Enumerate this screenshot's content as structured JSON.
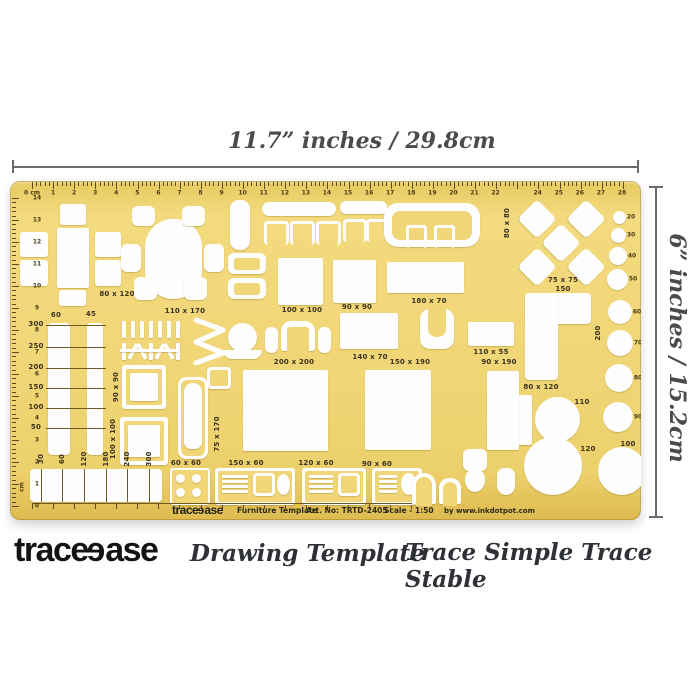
{
  "annotations": {
    "width_label": "11.7” inches / 29.8cm",
    "height_label": "6” inches / 15.2cm"
  },
  "template": {
    "top_ruler": [
      "0 cm",
      "1",
      "2",
      "3",
      "4",
      "5",
      "6",
      "7",
      "8",
      "9",
      "10",
      "11",
      "12",
      "13",
      "14",
      "15",
      "16",
      "17",
      "18",
      "19",
      "20",
      "21",
      "22",
      "24",
      "25",
      "26",
      "27",
      "28"
    ],
    "left_ruler": [
      "14",
      "13",
      "12",
      "11",
      "10",
      "9",
      "8",
      "7",
      "6",
      "5",
      "4",
      "3",
      "2",
      "1",
      "0"
    ],
    "left_ruler_unit": "cm",
    "size_labels": [
      "80 x 120",
      "110 x 170",
      "100 x 100",
      "90 x 90",
      "180 x 70",
      "140 x 70",
      "200 x 200",
      "150 x 190",
      "110 x 55",
      "90 x 190",
      "80 x 120",
      "110",
      "120",
      "100",
      "75 x 75",
      "150",
      "60 x 60",
      "150 x 60",
      "120 x 60",
      "90 x 60"
    ],
    "vertical_labels": [
      "80 x 80",
      "90 x 90",
      "100 x 100",
      "75 x 170",
      "200"
    ],
    "circle_labels": [
      "20",
      "30",
      "40",
      "50",
      "60",
      "70",
      "80",
      "90"
    ],
    "left_scale": [
      "300",
      "250",
      "200",
      "150",
      "100",
      "50"
    ],
    "slot_headers": [
      "60",
      "45"
    ],
    "bottom_scale": [
      "30",
      "60",
      "120",
      "180",
      "240",
      "300"
    ],
    "print": {
      "logo_pre": "trace",
      "logo_rev": "e",
      "logo_post": "ase",
      "subtitle": "Furniture Template",
      "art_no": "Art. No: TRTD-2405",
      "scale": "Scale - 1:50",
      "credit": "by www.inkdotpot.com"
    }
  },
  "branding": {
    "logo_pre": "trace",
    "logo_rev": "e",
    "logo_post": "ase",
    "tagline": "Drawing Template",
    "slogan": "Trace Simple Trace Stable"
  },
  "colors": {
    "template_yellow": "#f1d677",
    "template_edge": "#c9a83a",
    "print_ink": "#3b3220",
    "annotation_gray": "#4b4b4b",
    "brand_black": "#141414",
    "cutout_white": "#ffffff"
  }
}
